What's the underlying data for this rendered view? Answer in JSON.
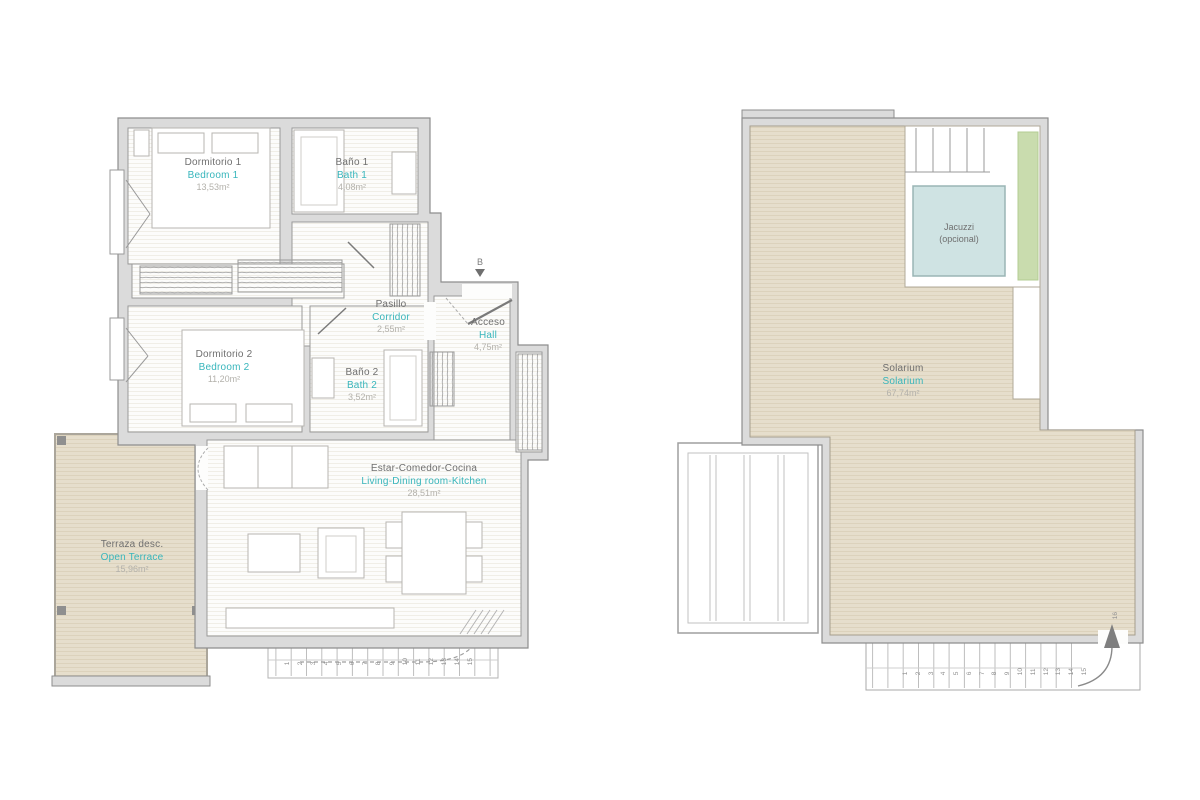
{
  "colors": {
    "accent_teal": "#38b6bc",
    "wall_fill": "#dbdbdb",
    "wall_line": "#8e8e8e",
    "terrace_beige": "#e6decc",
    "jacuzzi_blue": "#cfe3e3",
    "green_strip": "#c9dcae",
    "label_gray": "#6f6f6f",
    "area_gray": "#b3b1ab"
  },
  "floor_plan": {
    "rooms": [
      {
        "id": "bedroom1",
        "label_es": "Dormitorio 1",
        "label_en": "Bedroom 1",
        "area": "13,53m²"
      },
      {
        "id": "bath1",
        "label_es": "Baño 1",
        "label_en": "Bath 1",
        "area": "4,08m²"
      },
      {
        "id": "corridor",
        "label_es": "Pasillo",
        "label_en": "Corridor",
        "area": "2,55m²"
      },
      {
        "id": "hall",
        "label_es": "Acceso",
        "label_en": "Hall",
        "area": "4,75m²"
      },
      {
        "id": "bedroom2",
        "label_es": "Dormitorio 2",
        "label_en": "Bedroom 2",
        "area": "11,20m²"
      },
      {
        "id": "bath2",
        "label_es": "Baño 2",
        "label_en": "Bath 2",
        "area": "3,52m²"
      },
      {
        "id": "living",
        "label_es": "Estar-Comedor-Cocina",
        "label_en": "Living-Dining room-Kitchen",
        "area": "28,51m²"
      },
      {
        "id": "terrace",
        "label_es": "Terraza desc.",
        "label_en": "Open Terrace",
        "area": "15,96m²"
      }
    ],
    "entrance_marker": "B",
    "stairs": {
      "numbers": [
        "1",
        "2",
        "3",
        "4",
        "5",
        "6",
        "7",
        "8",
        "9",
        "10",
        "11",
        "12",
        "13",
        "14",
        "15"
      ]
    }
  },
  "roof_plan": {
    "rooms": [
      {
        "id": "solarium",
        "label_es": "Solarium",
        "label_en": "Solarium",
        "area": "67,74m²"
      },
      {
        "id": "jacuzzi",
        "label_line1": "Jacuzzi",
        "label_line2": "(opcional)"
      }
    ],
    "stairs": {
      "numbers": [
        "1",
        "2",
        "3",
        "4",
        "5",
        "6",
        "7",
        "8",
        "9",
        "10",
        "11",
        "12",
        "13",
        "14",
        "15"
      ],
      "last_step": "16"
    }
  }
}
